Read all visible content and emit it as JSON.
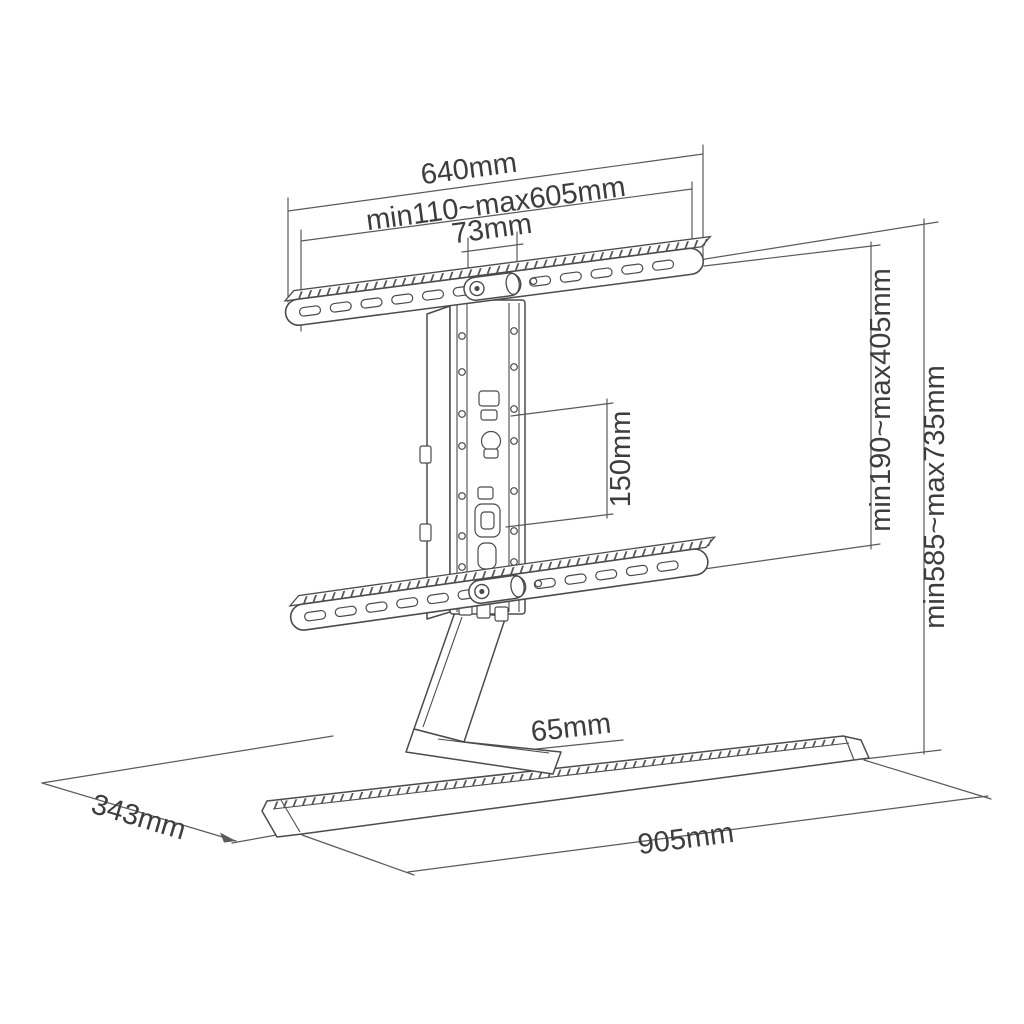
{
  "diagram": {
    "background": "#ffffff",
    "line_color": "#4b4b4b",
    "dim_line_color": "#5a5a5a",
    "text_color": "#3d3d3d",
    "labels": {
      "top_bracket_width": "640mm",
      "bracket_adjust_range": "min110~max605mm",
      "center_column_width": "73mm",
      "hole_pitch_vertical": "150mm",
      "bracket_height_range": "min190~max405mm",
      "overall_height_range": "min585~max735mm",
      "base_thickness": "65mm",
      "base_depth": "343mm",
      "base_width": "905mm"
    }
  }
}
